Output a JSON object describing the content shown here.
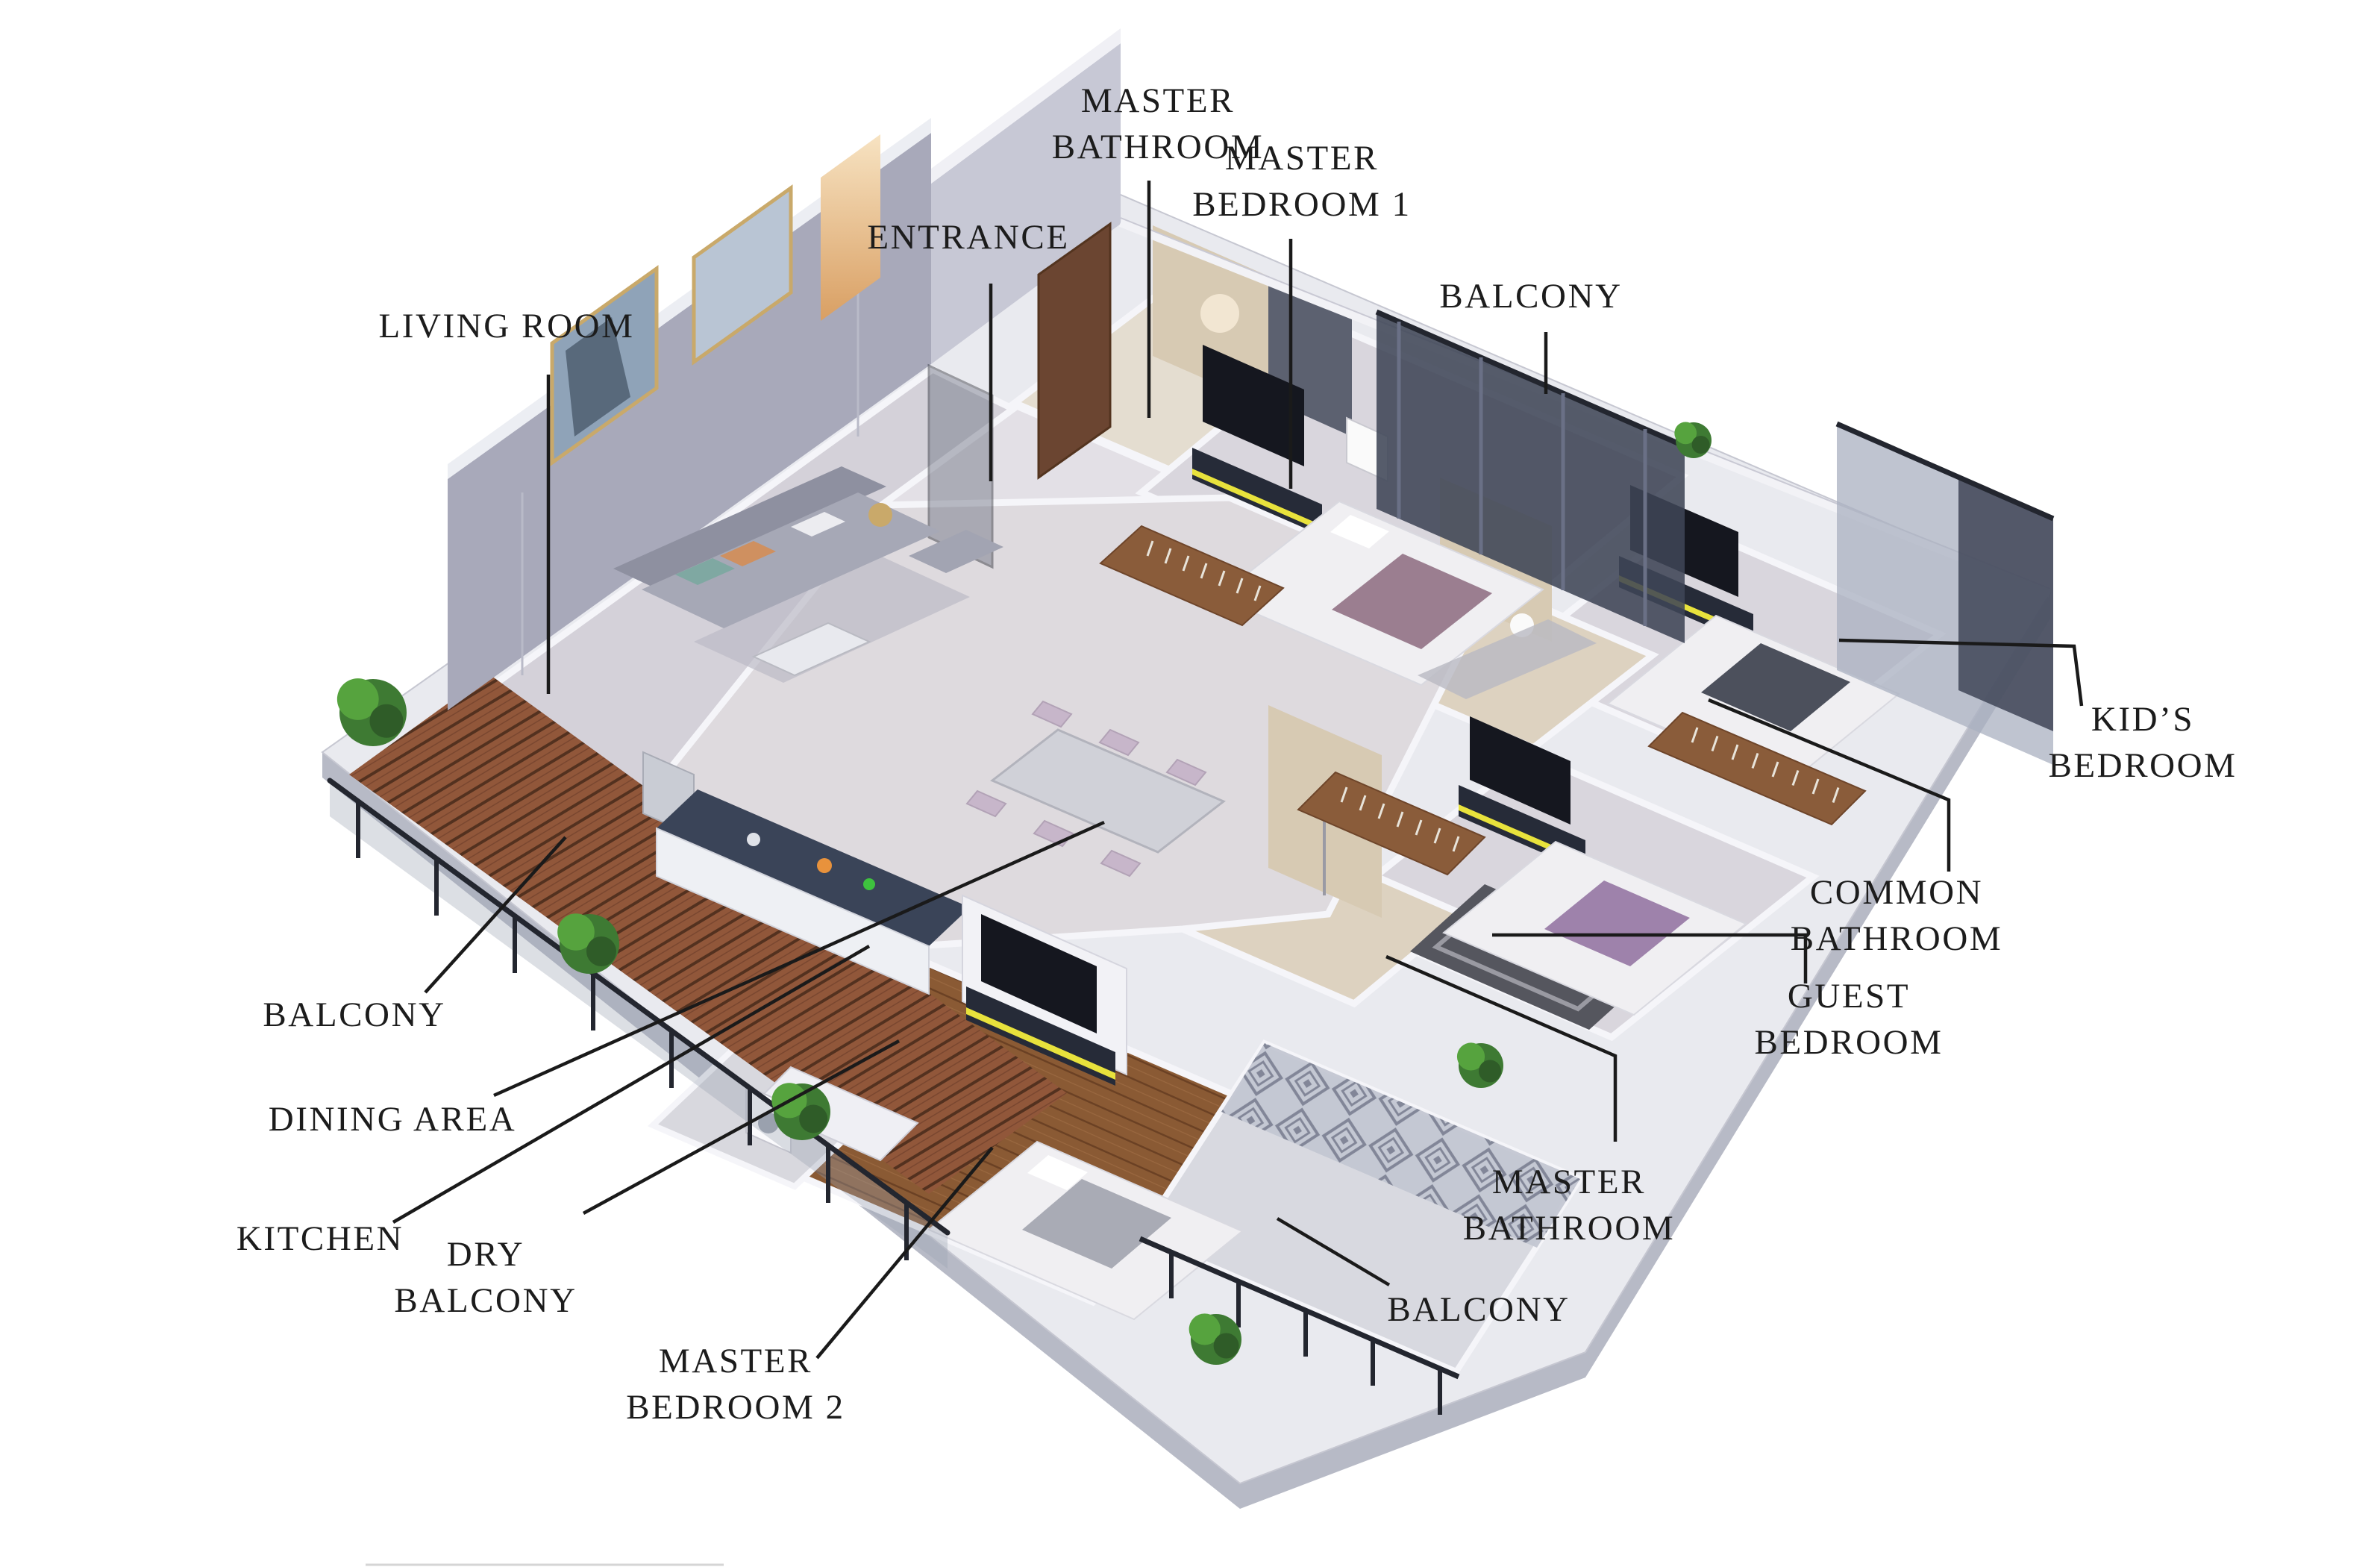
{
  "image": {
    "kind": "3d-isometric-apartment-floor-plan-render",
    "background": "#ffffff"
  },
  "labels": [
    {
      "id": "master-bathroom-top",
      "text": "MASTER BATHROOM",
      "lines": [
        "MASTER",
        "BATHROOM"
      ]
    },
    {
      "id": "master-bedroom-1",
      "text": "MASTER BEDROOM 1",
      "lines": [
        "MASTER",
        "BEDROOM 1"
      ]
    },
    {
      "id": "entrance",
      "text": "ENTRANCE",
      "lines": [
        "ENTRANCE"
      ]
    },
    {
      "id": "balcony-top",
      "text": "BALCONY",
      "lines": [
        "BALCONY"
      ]
    },
    {
      "id": "living-room",
      "text": "LIVING ROOM",
      "lines": [
        "LIVING ROOM"
      ]
    },
    {
      "id": "kids-bedroom",
      "text": "KID'S BEDROOM",
      "lines": [
        "KID’S",
        "BEDROOM"
      ]
    },
    {
      "id": "common-bathroom",
      "text": "COMMON BATHROOM",
      "lines": [
        "COMMON",
        "BATHROOM"
      ]
    },
    {
      "id": "guest-bedroom",
      "text": "GUEST BEDROOM",
      "lines": [
        "GUEST",
        "BEDROOM"
      ]
    },
    {
      "id": "balcony-left",
      "text": "BALCONY",
      "lines": [
        "BALCONY"
      ]
    },
    {
      "id": "dining-area",
      "text": "DINING AREA",
      "lines": [
        "DINING AREA"
      ]
    },
    {
      "id": "kitchen",
      "text": "KITCHEN",
      "lines": [
        "KITCHEN"
      ]
    },
    {
      "id": "dry-balcony",
      "text": "DRY BALCONY",
      "lines": [
        "DRY",
        "BALCONY"
      ]
    },
    {
      "id": "master-bedroom-2",
      "text": "MASTER BEDROOM 2",
      "lines": [
        "MASTER",
        "BEDROOM 2"
      ]
    },
    {
      "id": "master-bathroom-2",
      "text": "MASTER BATHROOM",
      "lines": [
        "MASTER",
        "BATHROOM"
      ]
    },
    {
      "id": "balcony-bottom",
      "text": "BALCONY",
      "lines": [
        "BALCONY"
      ]
    }
  ],
  "colors": {
    "label_text": "#1c1c1c",
    "leader_line": "#1a1a1a",
    "slab_top": "#e9eaef",
    "slab_side": "#b7bac6",
    "wall_white": "#f5f5f9",
    "wall_lavender": "#a8a9ba",
    "wall_entrance": "#c7c8d5",
    "wall_tile_beige": "#d7cab3",
    "wall_accent_gray": "#5c6170",
    "floor_light": "#d9d6dd",
    "floor_bath": "#ddd2c0",
    "wood_room": "#8a5a34",
    "wood_deck": "#91573a",
    "glass_dark": "#3f4557",
    "glass_sheer": "#aab0c0",
    "railing_black": "#23262f",
    "accent_yellow": "#e8e23c",
    "console_dark": "#262b38",
    "tv_black": "#15171f",
    "sofa_gray": "#a6a8b6",
    "bed_white": "#f0eff2",
    "throw_mauve": "#9b7e90",
    "throw_purple": "#9e82ab",
    "blanket_gray": "#4c505c",
    "chair_pink": "#c7b6ca",
    "plant_green": "#3e7a33",
    "plant_green_light": "#56a33e",
    "art_gold_frame": "#c9a96a",
    "niche_glow": "#e8c089"
  }
}
